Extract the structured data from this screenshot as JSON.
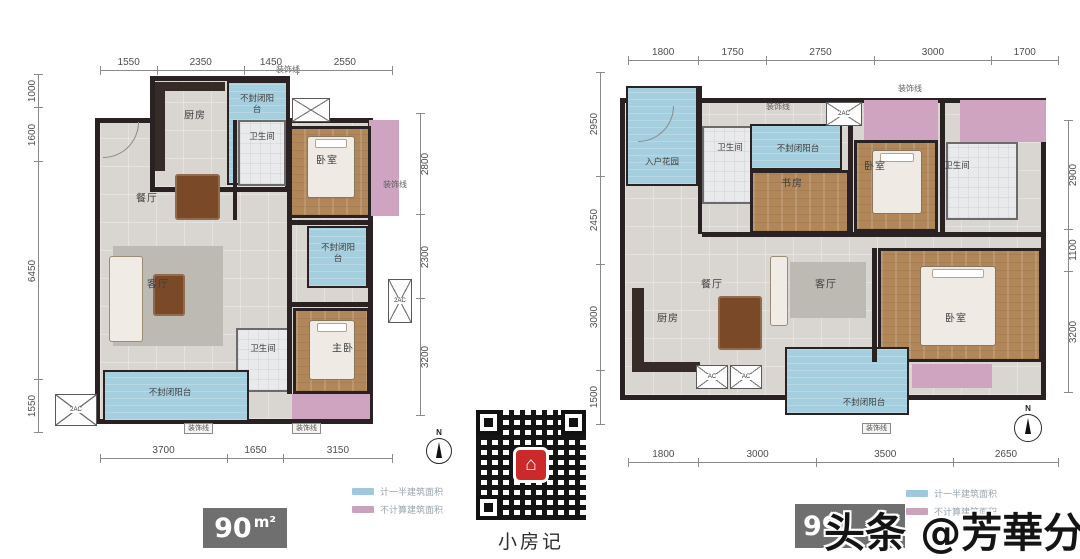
{
  "shared": {
    "compass_n": "N",
    "room_labels": {
      "kitchen": "厨房",
      "bathroom": "卫生间",
      "bedroom": "卧室",
      "master_bedroom": "主卧",
      "dining": "餐厅",
      "living": "客厅",
      "balcony": "不封闭阳台",
      "entry_garden": "入户花园",
      "study": "书房",
      "decor_line": "装饰线",
      "ac2": "2AC",
      "ac": "AC"
    },
    "legend": {
      "half_area_label": "计一半建筑面积",
      "excluded_area_label": "不计算建筑面积"
    },
    "colors": {
      "balcony_blue": "#a5cede",
      "decor_pink": "#cfa4c1",
      "wall_dark": "#2a2123",
      "floor_gray": "#d9d6d2",
      "wood_brown": "#b1875a",
      "legend_blue": "#9fc8dc",
      "legend_pink": "#c9a2bd",
      "area_box_gray": "#6f6f6f",
      "qr_red": "#cc2a2a"
    }
  },
  "left_plan": {
    "area": {
      "value": "90",
      "unit": "m²"
    },
    "dims": {
      "top": [
        "1550",
        "2350",
        "1450",
        "2550"
      ],
      "left": [
        "1000",
        "1600",
        "6450",
        "1550"
      ],
      "right": [
        "2800",
        "2300",
        "3200"
      ],
      "bottom": [
        "3700",
        "1650",
        "3150"
      ]
    }
  },
  "right_plan": {
    "area": {
      "value": "99"
    },
    "dims": {
      "top": [
        "1800",
        "1750",
        "2750",
        "3000",
        "1700"
      ],
      "left": [
        "2950",
        "2450",
        "3000",
        "1500"
      ],
      "right": [
        "2900",
        "1100",
        "3200"
      ],
      "bottom": [
        "1800",
        "3000",
        "3500",
        "2650"
      ]
    }
  },
  "qr": {
    "caption": "小房记"
  },
  "watermark": {
    "text": "头条 @芳華分析师"
  }
}
